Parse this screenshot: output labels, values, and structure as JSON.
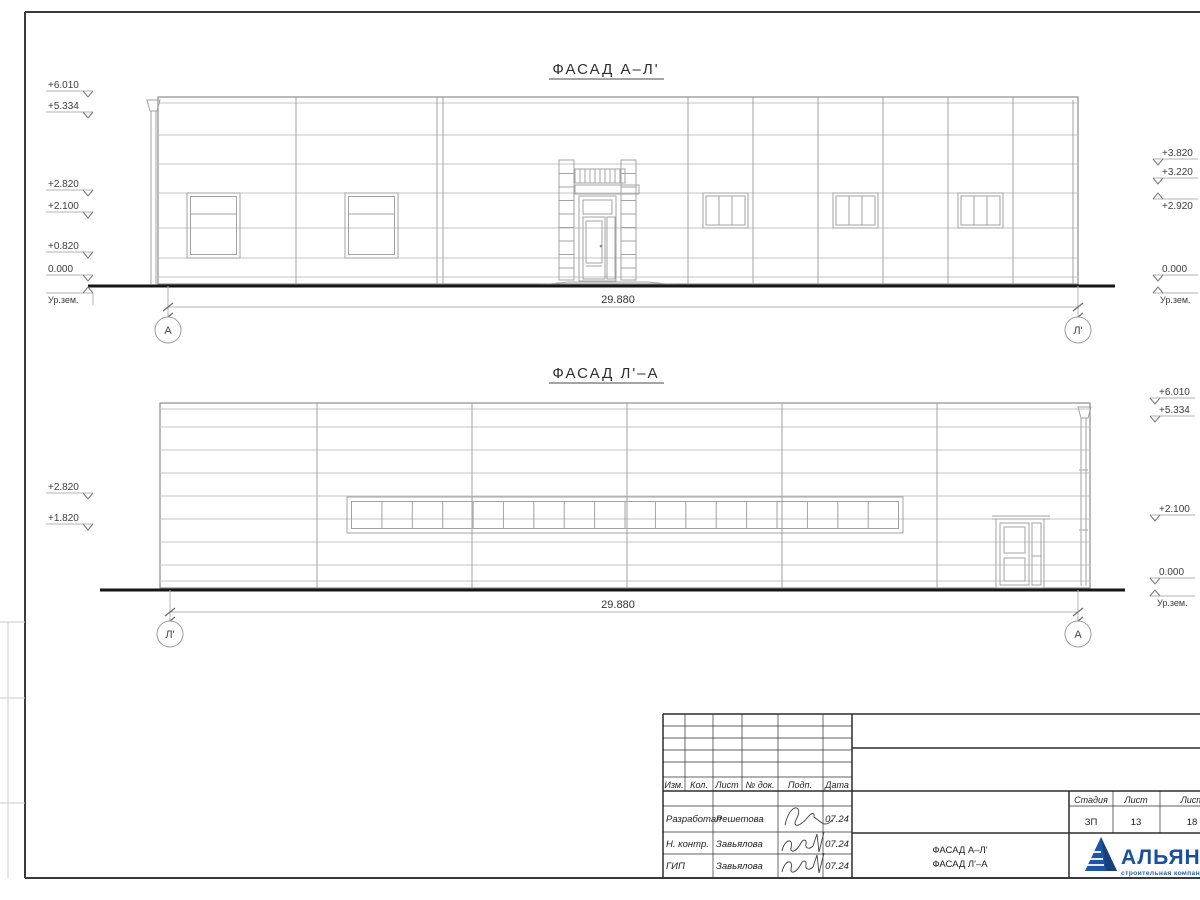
{
  "sheet": {
    "facades": [
      {
        "title": "ФАСАД А–Л'",
        "dimension": "29.880",
        "axis_left": "А",
        "axis_right": "Л'",
        "marks_left": [
          "+6.010",
          "+5.334",
          "+2.820",
          "+2.100",
          "+0.820",
          "0.000"
        ],
        "marks_right": [
          "+3.820",
          "+3.220",
          "+2.920",
          "0.000"
        ],
        "ground_label": "Ур.зем."
      },
      {
        "title": "ФАСАД Л'–А",
        "dimension": "29.880",
        "axis_left": "Л'",
        "axis_right": "А",
        "marks_left": [
          "+2.820",
          "+1.820"
        ],
        "marks_right": [
          "+6.010",
          "+5.334",
          "+2.100",
          "0.000"
        ],
        "ground_label": "Ур.зем."
      }
    ],
    "titleblock": {
      "cols": {
        "izm": "Изм.",
        "kol": "Кол.",
        "list": "Лист",
        "doc": "№ док.",
        "sign": "Подп.",
        "date": "Дата"
      },
      "rows": [
        {
          "role": "Разработал",
          "name": "Решетова",
          "date": "07.24"
        },
        {
          "role": "Н. контр.",
          "name": "Завьялова",
          "date": "07.24"
        },
        {
          "role": "ГИП",
          "name": "Завьялова",
          "date": "07.24"
        }
      ],
      "stage_col": "Стадия",
      "sheet_col": "Лист",
      "sheets_col": "Листов",
      "stage": "ЗП",
      "sheet_no": "13",
      "sheets_total": "18",
      "name_line1": "ФАСАД А–Л'",
      "name_line2": "ФАСАД Л'–А",
      "logo": "АЛЬЯНС",
      "logo_sub": "строительная компания"
    },
    "colors": {
      "logo_blue": "#1d55a5"
    }
  }
}
